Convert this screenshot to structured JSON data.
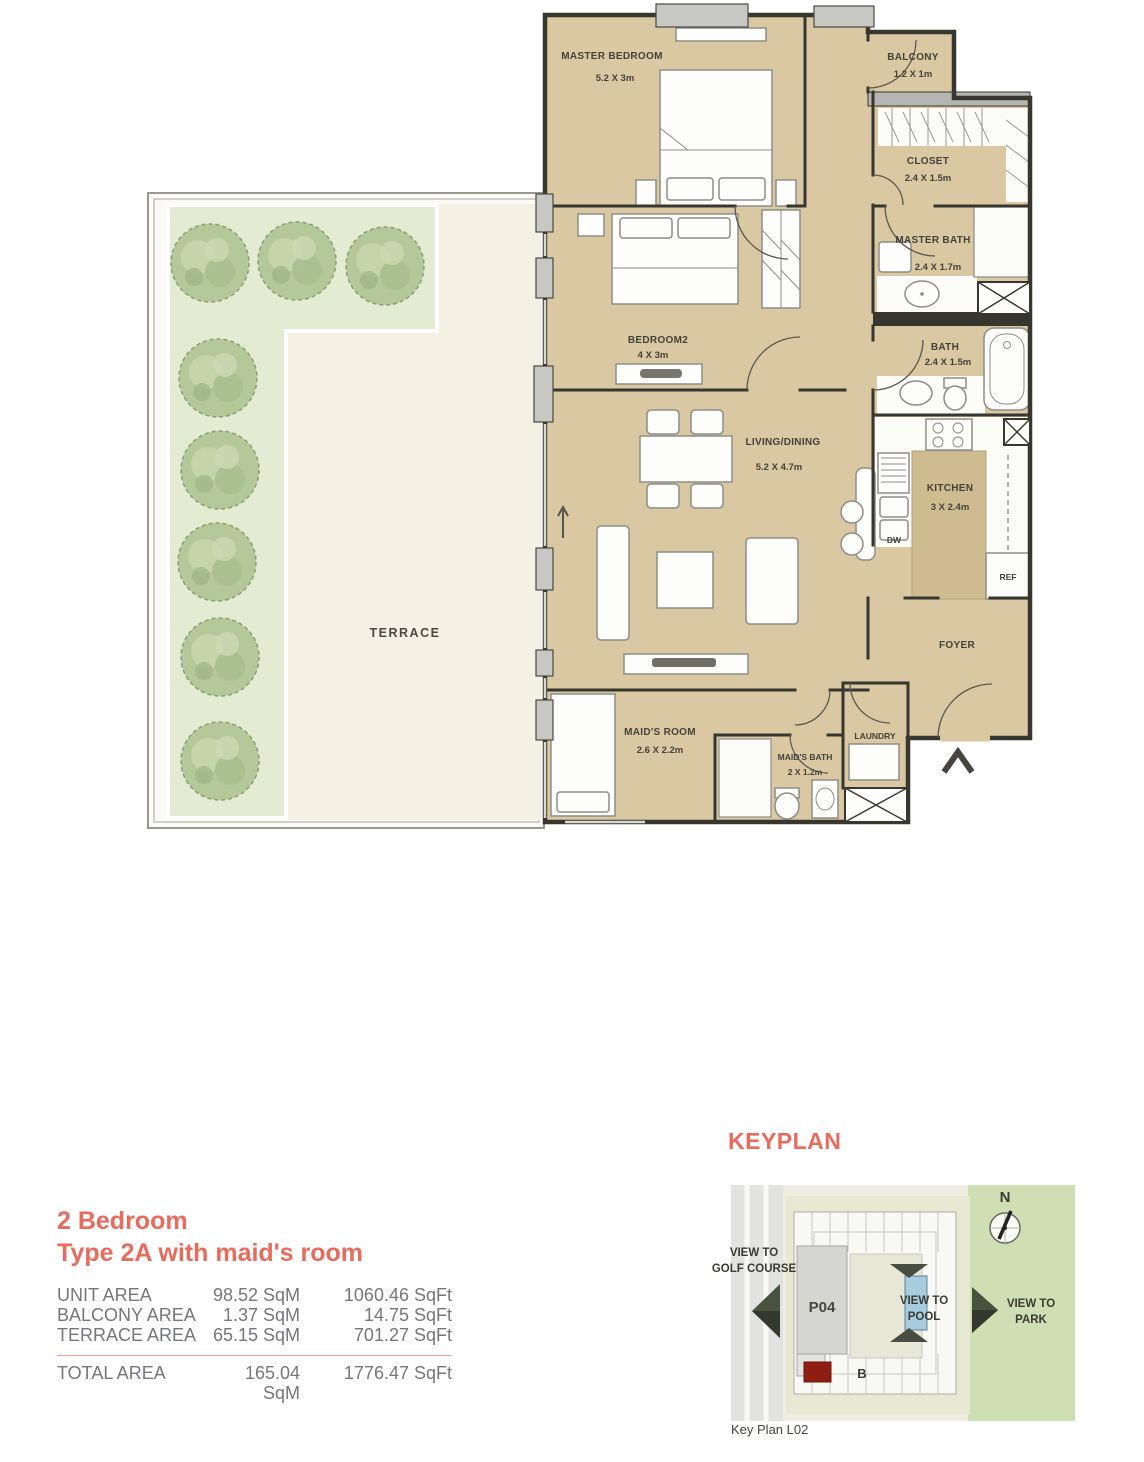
{
  "floorplan": {
    "rooms": {
      "master_bedroom": {
        "label": "MASTER BEDROOM",
        "dim": "5.2 X 3m"
      },
      "balcony": {
        "label": "BALCONY",
        "dim": "1.2 X 1m"
      },
      "closet": {
        "label": "CLOSET",
        "dim": "2.4 X 1.5m"
      },
      "master_bath": {
        "label": "MASTER BATH",
        "dim": "2.4 X 1.7m"
      },
      "bedroom2": {
        "label": "BEDROOM2",
        "dim": "4 X 3m"
      },
      "bath": {
        "label": "BATH",
        "dim": "2.4 X 1.5m"
      },
      "living_dining": {
        "label": "LIVING/DINING",
        "dim": "5.2 X 4.7m"
      },
      "kitchen": {
        "label": "KITCHEN",
        "dim": "3 X 2.4m"
      },
      "foyer": {
        "label": "FOYER"
      },
      "maids_room": {
        "label": "MAID'S ROOM",
        "dim": "2.6 X 2.2m"
      },
      "maids_bath": {
        "label": "MAID'S BATH",
        "dim": "2 X 1.2m"
      },
      "laundry": {
        "label": "LAUNDRY"
      },
      "terrace": {
        "label": "TERRACE"
      }
    },
    "appliances": {
      "dishwasher": "DW",
      "refrigerator": "REF"
    }
  },
  "details": {
    "title_line1": "2 Bedroom",
    "title_line2": "Type 2A with maid's room",
    "rows": [
      {
        "label": "UNIT AREA",
        "sqm": "98.52 SqM",
        "sqft": "1060.46 SqFt"
      },
      {
        "label": "BALCONY AREA",
        "sqm": "1.37 SqM",
        "sqft": "14.75 SqFt"
      },
      {
        "label": "TERRACE AREA",
        "sqm": "65.15 SqM",
        "sqft": "701.27 SqFt"
      }
    ],
    "total": {
      "label": "TOTAL AREA",
      "sqm": "165.04 SqM",
      "sqft": "1776.47 SqFt"
    }
  },
  "keyplan": {
    "title": "KEYPLAN",
    "north_label": "N",
    "building_label": "P04",
    "block_label": "B",
    "view_golf": [
      "VIEW TO",
      "GOLF COURSE"
    ],
    "view_pool": [
      "VIEW TO",
      "POOL"
    ],
    "view_park": [
      "VIEW TO",
      "PARK"
    ],
    "caption": "Key Plan L02"
  },
  "colors": {
    "accent": "#ea6a5c",
    "floor_beige": "#d9c8a2",
    "terrace_green": "#e3ebd2",
    "park_green": "#cfdfb3",
    "unit_highlight_red": "#8e1d12",
    "text_gray": "#76777a"
  }
}
